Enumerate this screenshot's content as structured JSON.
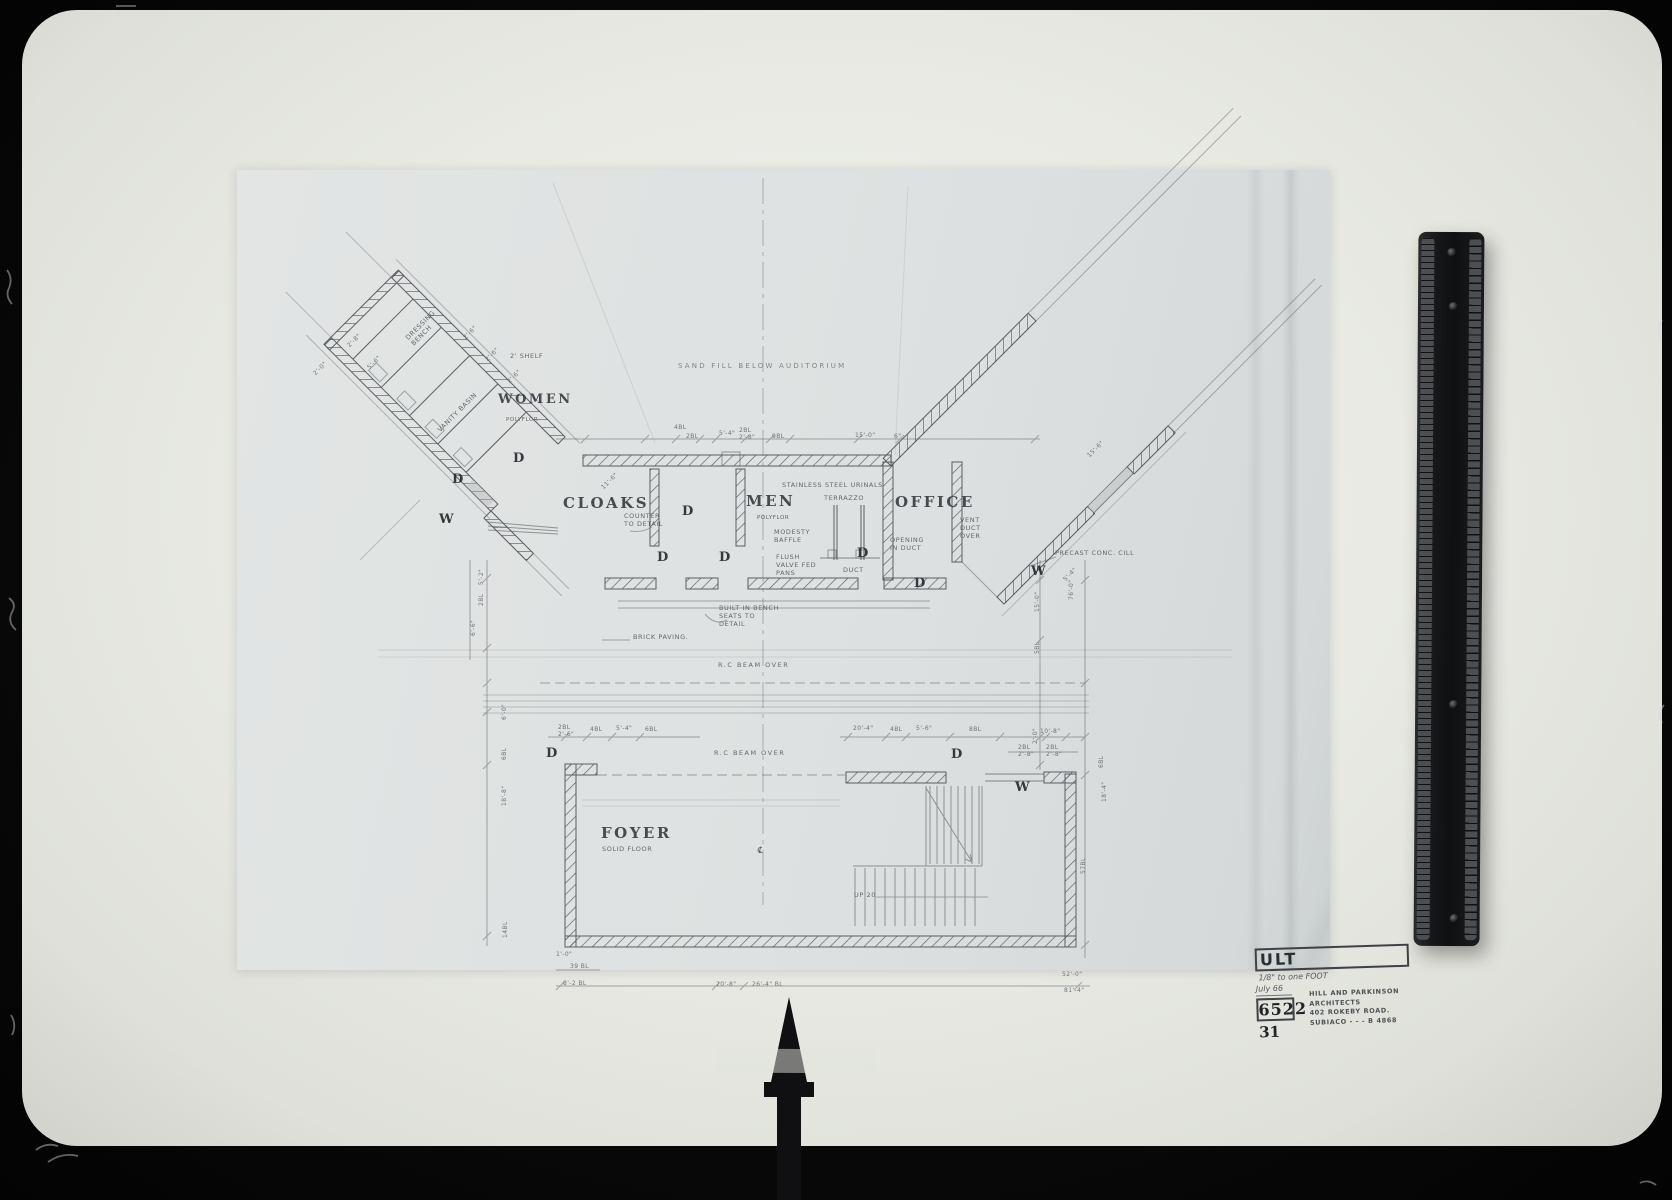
{
  "photo": {
    "background_color": "#0a0a0a",
    "board_color": "#e9eae4",
    "sheet_color": "#dde1e1",
    "line_color": "#5a5e63"
  },
  "plan": {
    "rooms": {
      "women": "WOMEN",
      "cloaks": "CLOAKS",
      "men": "MEN",
      "office": "OFFICE",
      "foyer": "FOYER"
    },
    "floors": {
      "women_floor": "POLYFLOR",
      "men_floor": "POLYFLOR",
      "foyer_floor": "SOLID FLOOR"
    },
    "markers": {
      "door": "D",
      "window": "W"
    },
    "annotations": {
      "sand_fill": "SAND FILL BELOW AUDITORIUM",
      "shelf": "2' SHELF",
      "counter_note": "COUNTER TO DETAIL",
      "urinals": "STAINLESS STEEL URINALS",
      "terrazzo": "TERRAZZO",
      "modesty": "MODESTY BAFFLE",
      "flush_pans": "FLUSH VALVE FED PANS",
      "duct": "DUCT",
      "opening_duct": "OPENING IN DUCT",
      "vent_duct": "VENT DUCT OVER",
      "precast_cill": "PRECAST CONC. CILL",
      "bench_seats": "BUILT IN BENCH SEATS TO DETAIL",
      "brick_paving": "BRICK PAVING.",
      "rc_beam": "R.C BEAM OVER",
      "up_20": "UP 20",
      "vanity": "VANITY BASIN",
      "dressing": "DRESSING BENCH",
      "centreline": "℄"
    },
    "dims": {
      "top": [
        "4BL",
        "2BL",
        "5'-4\"",
        "2BL 2'-8\"",
        "9BL",
        "15'-0\"",
        "6\""
      ],
      "mid_left": [
        "2BL 2'-6\"",
        "4BL",
        "5'-4\"",
        "6BL"
      ],
      "mid_right": [
        "20'-4\"",
        "4BL",
        "5'-6\"",
        "8BL",
        "10'-8\"",
        "2BL 2'-8\"",
        "2BL 2'-8\""
      ],
      "bottom": [
        "1'-0\"",
        "39 BL",
        "8'-2 BL",
        "20'-8\"",
        "26'-4\" BL",
        "52'-0\"",
        "81'-4\""
      ],
      "left_vertical": [
        "5'-2\"",
        "2BL",
        "6'-6\"",
        "6'-0\"",
        "6BL",
        "18'-8\"",
        "14BL"
      ],
      "right_vertical": [
        "15'-0\"",
        "5BL",
        "76'-0\"",
        "2'-0\"",
        "6BL",
        "18'-4\"",
        "57BL"
      ],
      "diagonal": [
        "11'-6\"",
        "5'-4\"",
        "15'-6\"",
        "2'-6\"",
        "2'-6\"",
        "2'-6\"",
        "2'-8\"",
        "5'-6\"",
        "2'-0\""
      ]
    }
  },
  "title_block": {
    "project_code": "ULT",
    "scale_note": "1/8\" to one FOOT",
    "date": "July 66",
    "job_number": "6522",
    "sheet_number": "31",
    "firm_line1": "HILL AND PARKINSON",
    "firm_line2": "ARCHITECTS",
    "firm_line3": "402 ROKEBY ROAD.",
    "firm_line4": "SUBIACO - - - B 4868"
  }
}
